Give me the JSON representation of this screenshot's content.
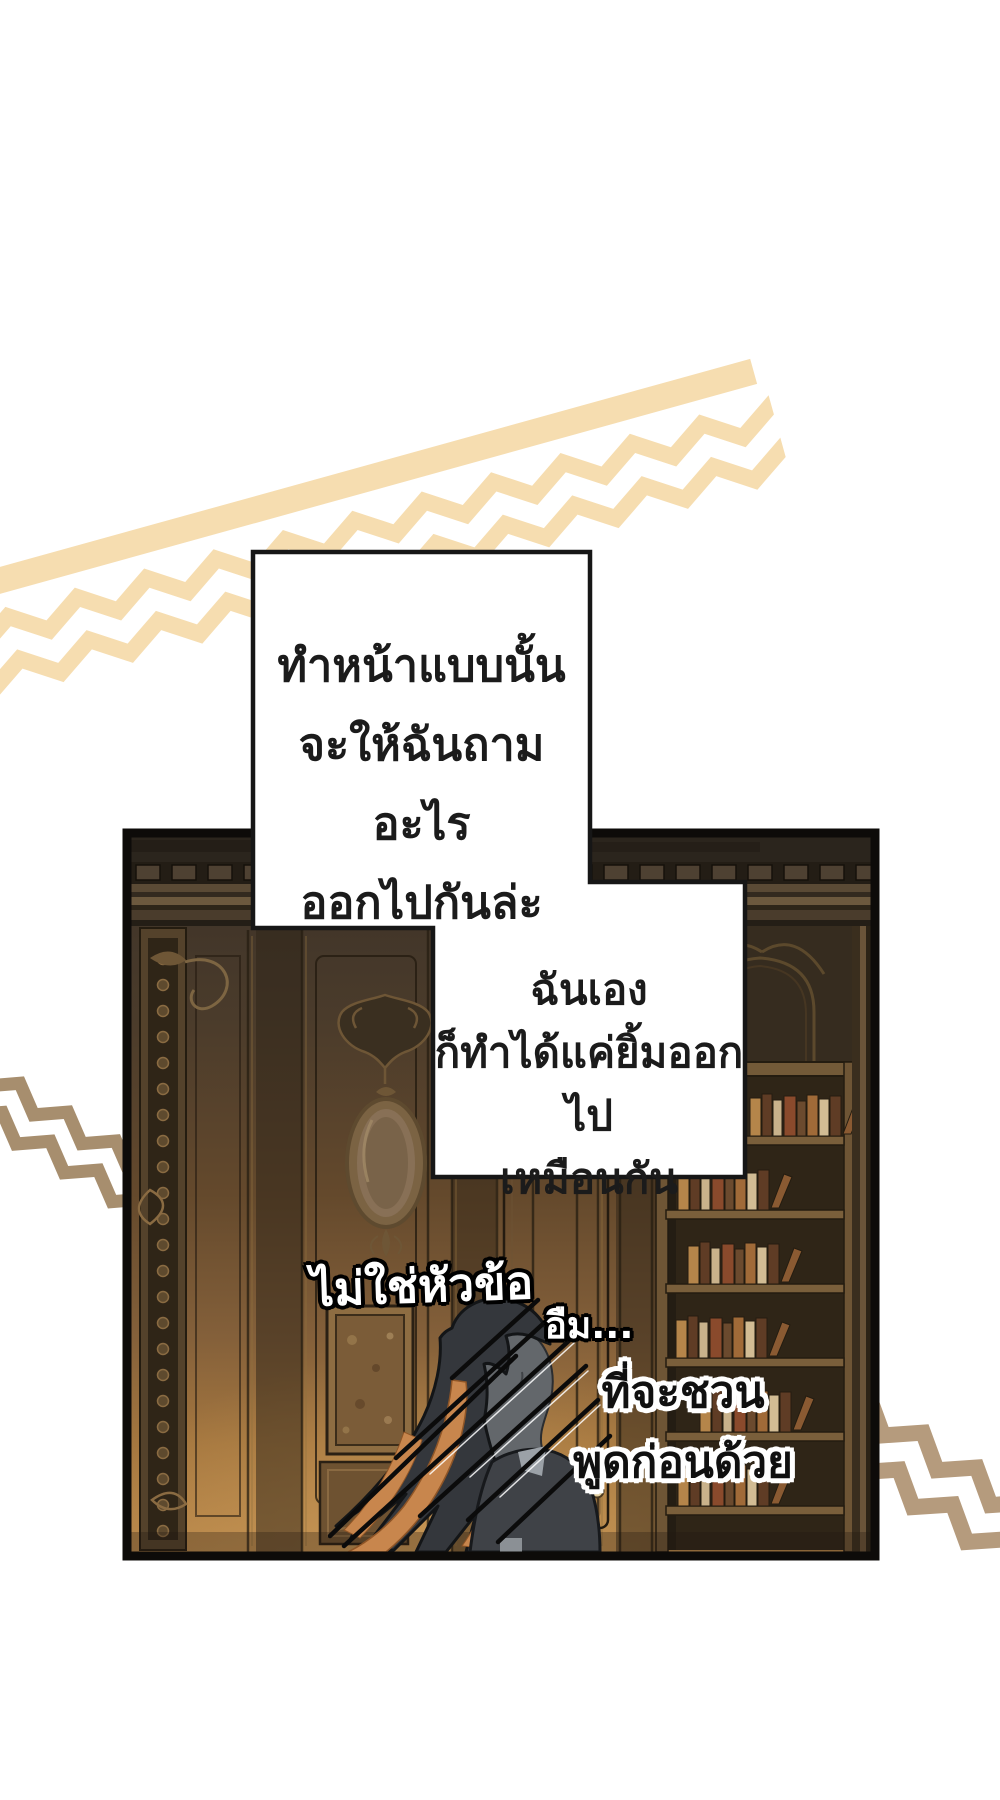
{
  "page": {
    "width": 1000,
    "height": 1800,
    "background": "#ffffff"
  },
  "colors": {
    "top_band": "#f6ddb0",
    "left_zigzag": "#a78e6e",
    "right_zigzag": "#b59b7d",
    "panel_border": "#0d0b09",
    "bubble_fill": "#ffffff",
    "bubble_border": "#161616",
    "wall_top": "#3b3127",
    "wall_bottom": "#b8874a",
    "hair": "#34373c",
    "hair_highlight": "#c8864d",
    "skin_silhouette": "#63676b",
    "jacket": "#3f4247",
    "text": "#1b1b1b"
  },
  "speech_bubble_1": {
    "lines": [
      "ทำหน้าแบบนั้น",
      "จะให้ฉันถามอะไร",
      "ออกไปกันล่ะ"
    ]
  },
  "speech_bubble_2": {
    "lines": [
      "ฉันเอง",
      "ก็ทำได้แค่ยิ้มออกไป",
      "เหมือนกัน"
    ]
  },
  "floating_captions": {
    "not_the_topic": "ไม่ใช่หัวข้อ",
    "hmm": "อืม...",
    "invite_line_1": "ที่จะชวน",
    "invite_line_2": "พูดก่อนด้วย"
  }
}
